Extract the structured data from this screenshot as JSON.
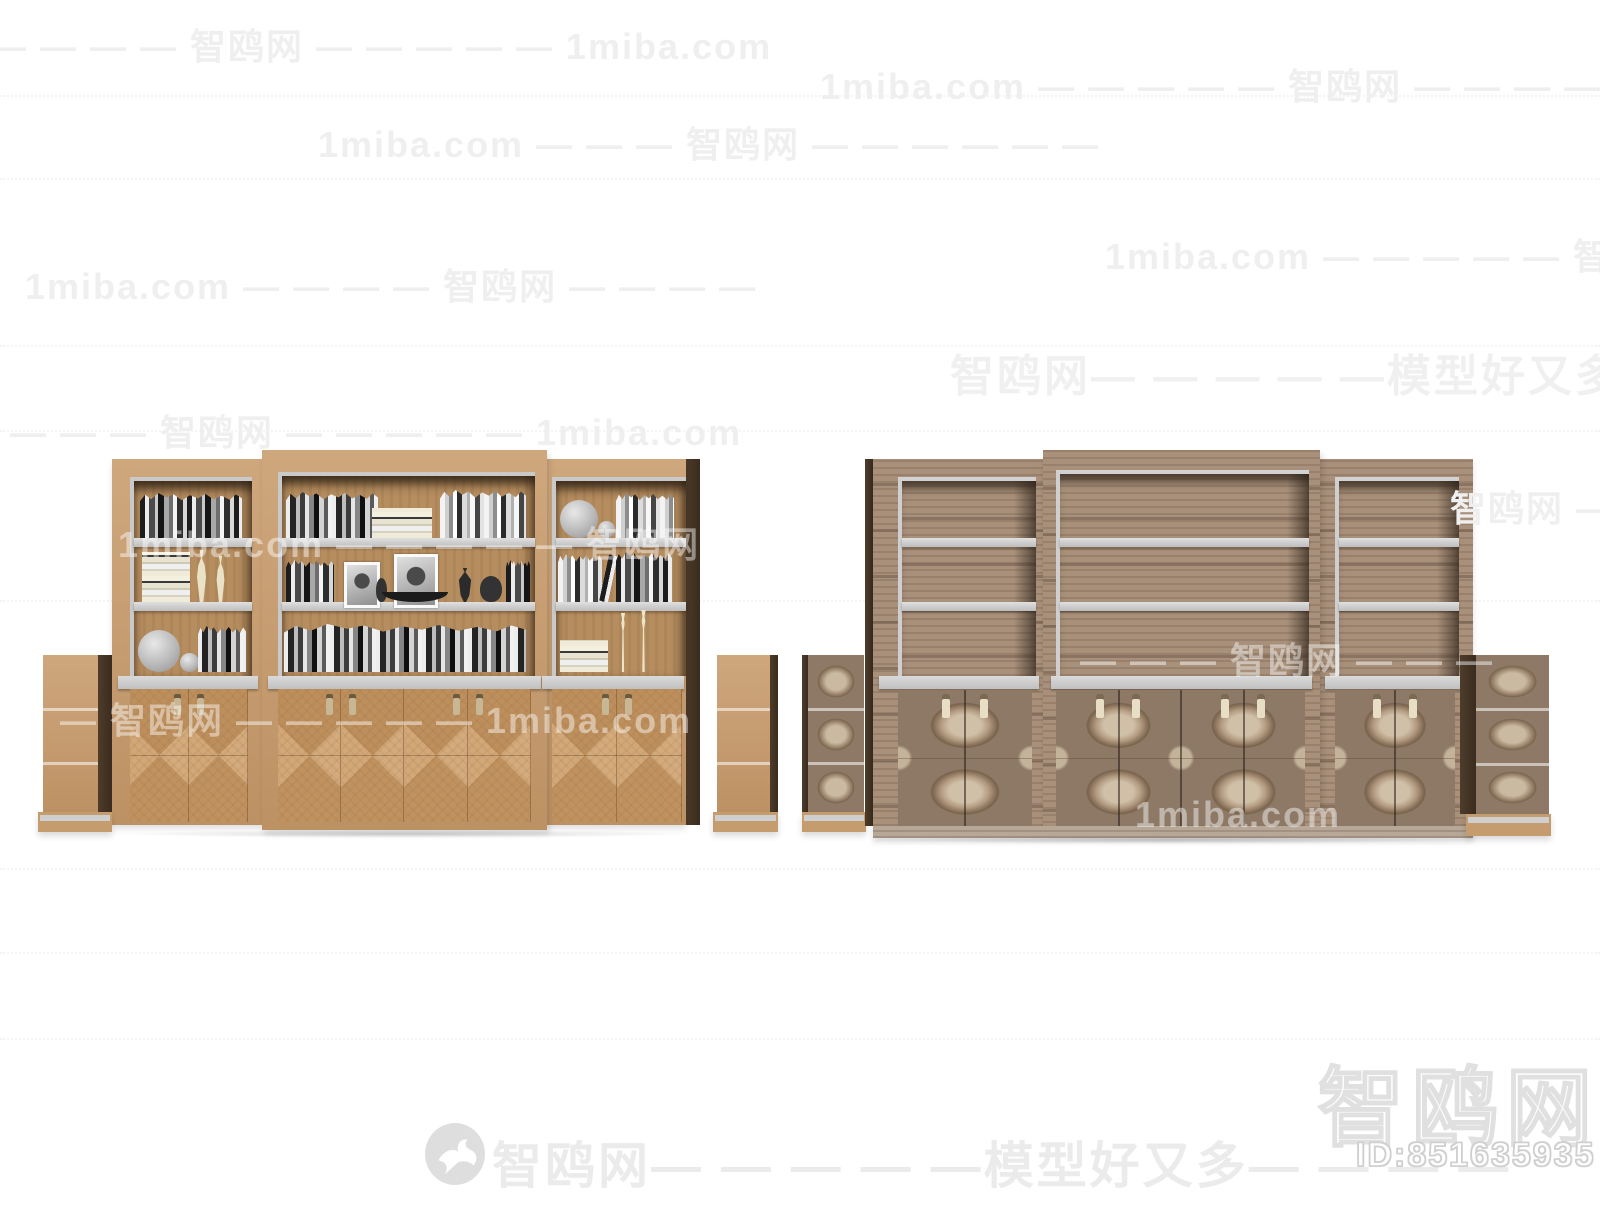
{
  "meta": {
    "site": "1miba.com",
    "brand": "智鸥网",
    "tagline": "模型好又多"
  },
  "watermarks": {
    "tiled": [
      {
        "text": "— — — — — 智鸥网 — — — — — 1miba.com"
      },
      {
        "text": "1miba.com — — — — — 智鸥网 — — — — — 1miba.com"
      },
      {
        "text": "1miba.com — — — 智鸥网 — — — — — —"
      },
      {
        "text": "1miba.com — — — — 智鸥网 — — — —"
      },
      {
        "text": "1miba.com — — — — — 智鸥网 — — — — — —"
      },
      {
        "text": "— — — — 智鸥网 — — — — — 1miba.com"
      },
      {
        "text": "1miba.com — — — — — 智鸥网 — — —"
      },
      {
        "text": "智鸥网 — — —"
      },
      {
        "text": "— 智鸥网 — — — — — 1miba.com"
      },
      {
        "text": "— — — 智鸥网 — — —"
      },
      {
        "text": "1miba.com"
      }
    ],
    "banner": {
      "text": "智鸥网— — — — —模型好又多— — — —"
    },
    "footer": {
      "text": "智鸥网— — — — —模型好又多— — — —",
      "logo": "seagull-icon"
    },
    "corner": {
      "brand": "智鸥网",
      "id_label": "ID:851635935"
    }
  },
  "palette": {
    "light_wood": "#c89b6b",
    "light_wood_door": "#cba273",
    "walnut": "#a8907a",
    "walnut_door": "#8d7966",
    "shelf_gray": "#c9c9c9",
    "dark_side": "#4e3c2b",
    "watermark_gray": "#efefef"
  },
  "scene": {
    "left_unit": {
      "label": "Light wood bookcase wall unit filled with books and decor, 3 sections, 8 lower doors, 2 small side drawer cabinets"
    },
    "right_unit": {
      "label": "Walnut bookcase wall unit with empty shelves and burl-pattern doors, 3 sections, 8 lower doors, 2 small patterned side cabinets"
    }
  }
}
